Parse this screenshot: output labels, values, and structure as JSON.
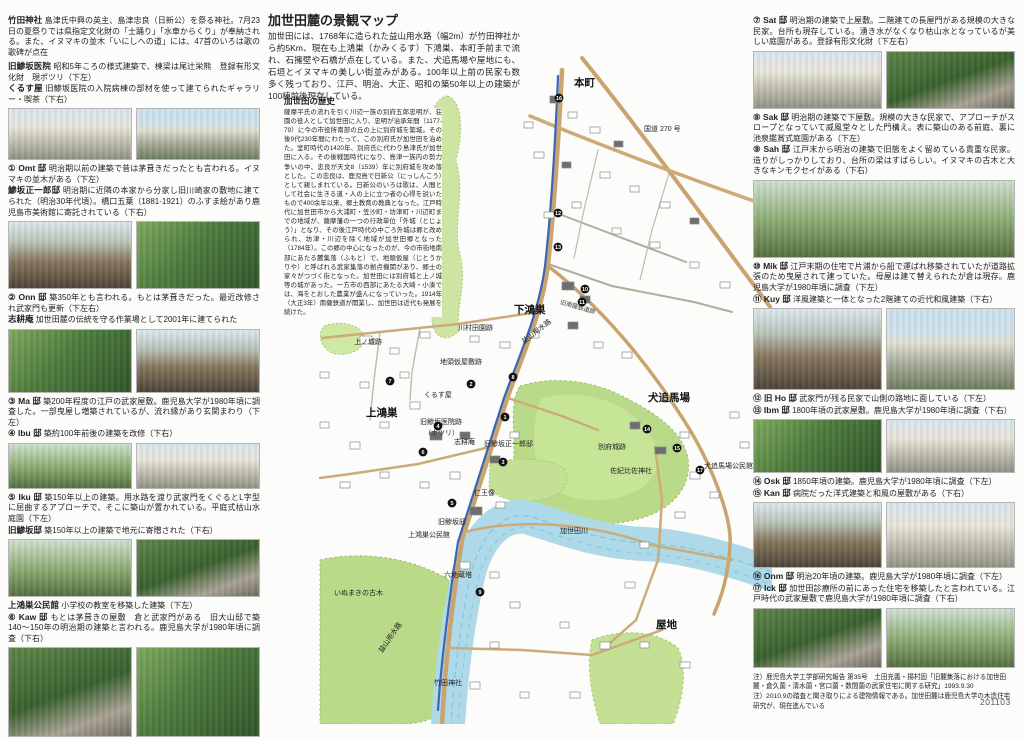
{
  "doc": {
    "number": "201103"
  },
  "center": {
    "title": "加世田麓の景観マップ",
    "intro": "加世田には、1768年に造られた益山用水路（幅2m）が竹田神社から約5Km、現在も上鴻巣（かみくるす）下鴻巣、本町手前まで流れ、石擁壁や石橋が点在している。また、犬追馬場や屋地にも、石垣とイヌマキの美しい街並みがある。100年以上前の民家も数多く残っており、江戸、明治、大正、昭和の築50年以上の建築が100棟前後現存している。",
    "history_title": "加世田の歴史",
    "history": "薩摩平氏の流れを引く川辺一族の別府五郎忠明が、荘園の役人として加世田に入り、忠明が治承年間（1177-79）に今の市役所南部の丘の上に別府城を築城。その後9代230年間にわたって、この別府氏が加世田を治めた。室町時代の1420年、別府氏に代わり島津氏が加世田に入る。その後戦国時代になり、島津一族内の勢力争いの中、忠良が天文8（1539）年に別府城を攻め落とした。この忠良は、鹿児島で日新公（にっしんこう）として親しまれている。日新公のいろは歌は、人間として社会に生きる道・人の上に立つ者の心得を説いたもので400余年以来、郷土教育の教典となった。江戸時代に加世田市から大浦町・笠沙町・坊津町・川辺町までの地域が、薩摩藩の一つの行政単位「外城（とじょう）」となり、その後江戸時代の中ごろ外城は郷と改められ、坊津・川辺を除く地域が加世田郷となった（1784年）。この郷の中心になったのが、今の市街地南部にあたる麓集落（ふもと）で、地頭仮屋（じとうかりや）と呼ばれる武家集落の拠点機関があり、郷士の家々がつづく街となった。加世田には別府城と上ノ城等の城があった。一方市の西部にあたる大崎・小湊では、海をとおした農業が盛んになっていった。1914年（大正3年）南薩鉄道が開業し、加世田は近代も発展を続けた。"
  },
  "left": {
    "intro": [
      {
        "label": "竹田神社",
        "body": "島津氏中興の英主、島津忠良（日新公）を祭る神社。7月23日の夏祭りでは県指定文化財の「士踊り」「水車からくり」が奉納される。また、イヌマキの並木「いにしへの道」には、47首のいろは歌の歌碑が点在"
      },
      {
        "label": "旧鯵坂医院",
        "body": "昭和5年ころの様式建築で、棟梁は尾辻栄熊　登録有形文化財　現ポツリ（下左）"
      },
      {
        "label": "くるす屋",
        "body": "旧鯵坂医院の入院病棟の部材を使って建てられたギャラリー・喫茶（下右）"
      }
    ],
    "entries": [
      {
        "num": "①",
        "label": "Omt 邸",
        "body": "明治期以前の建築で昔は茅葺きだったとも言われる。イヌマキの並木がある（下左）"
      },
      {
        "num": "",
        "label": "鯵坂正一郎邸",
        "body": "明治期に近隣の本家から分家し旧川崎家の敷地に建てられた（明治30年代頃）。橋口五葉（1881-1921）のふすま絵があり鹿児島市美術館に寄託されている（下右）"
      },
      {
        "num": "②",
        "label": "Onn 邸",
        "body": "築350年とも言われる。もとは茅葺きだった。最近改修され武家門も更新（下左右）"
      },
      {
        "num": "",
        "label": "志耕庵",
        "body": "加世田麓の伝統を守る作業場として2001年に建てられた"
      },
      {
        "num": "③",
        "label": "Ma 邸",
        "body": "築200年程度の江戸の武家屋敷。鹿児島大学が1980年頃に調査した。一部曳屋し増築されているが、流れ縁があり玄関まわり（下左）"
      },
      {
        "num": "④",
        "label": "Ibu 邸",
        "body": "築約100年前後の建築を改修（下右）"
      },
      {
        "num": "⑤",
        "label": "Iku 邸",
        "body": "築150年以上の建築。用水路を渡り武家門をくぐるとL字型に屈曲するアプローチで、そこに築山が置かれている。平庭式枯山水庭園（下左）"
      },
      {
        "num": "",
        "label": "旧鯵坂邸",
        "body": "築150年以上の建築で地元に寄贈された（下右）"
      },
      {
        "num": "",
        "label": "上鴻巣公民館",
        "body": "小学校の教室を移築した建築（下左）"
      },
      {
        "num": "⑥",
        "label": "Kaw 邸",
        "body": "もとは茅葺きの屋敷　倉と武家門がある　旧大山邸で築140〜150年の明治期の建築と言われる。鹿児島大学が1980年頃に調査（下右）"
      }
    ]
  },
  "right": {
    "entries": [
      {
        "num": "⑦",
        "label": "Sat 邸",
        "body": "明治期の建築で上屋敷。二階建ての長屋門がある規模の大きな民家。台所も現存している。湧き水がなくなり枯山水となっているが美しい庭園がある。登録有形文化財（下左右）"
      },
      {
        "num": "⑧",
        "label": "Sak 邸",
        "body": "明治期の建築で下屋敷。規模の大きな民家で、アプローチがスロープとなっていて威風堂々とした門構え。表に築山のある前庭、裏に池泉鑑賞式庭園がある（下左）"
      },
      {
        "num": "⑨",
        "label": "Sah 邸",
        "body": "江戸末から明治の建築で旧態をよく留めている貴重な民家。造りがしっかりしており、台所の梁はすばらしい。イヌマキの古木と大きなキンモクセイがある（下右）"
      },
      {
        "num": "⑩",
        "label": "Mik 邸",
        "body": "江戸末期の住宅で片浦から船で運ばれ移築されていたが道路拡張のため曳屋されて建っていた。母屋は建て替えられたが倉は現存。鹿児島大学が1980年頃に調査（下左）"
      },
      {
        "num": "⑪",
        "label": "Kuy 邸",
        "body": "洋風建築と一体となった2階建ての近代和風建築（下右）"
      },
      {
        "num": "⑫",
        "label": "旧 Ho 邸",
        "body": "武家門が残る民家で山側の路地に面している（下左）"
      },
      {
        "num": "⑬",
        "label": "Ibm 邸",
        "body": "1800年頃の武家屋敷。鹿児島大学が1980年頃に調査（下右）"
      },
      {
        "num": "⑭",
        "label": "Osk 邸",
        "body": "1850年頃の建築。鹿児島大学が1980年頃に調査（下左）"
      },
      {
        "num": "⑮",
        "label": "Kan 邸",
        "body": "病院だった洋式建築と和風の屋敷がある（下右）"
      },
      {
        "num": "⑯",
        "label": "Onm 邸",
        "body": "明治20年頃の建築。鹿児島大学が1980年頃に調査（下左）"
      },
      {
        "num": "⑰",
        "label": "Ick 邸",
        "body": "加世田診療所の前にあった住宅を移築したと言われている。江戸時代の武家屋敷で鹿児島大学が1980年頃に調査（下右）"
      }
    ],
    "notes": [
      "注）鹿児島大学工学部研究報告 第35号　土田充義・揚村固「旧麓集落における加世田麓・倉久薗・清水薗・宮口薗・数間薗の武家住宅に関する研究」1993.9.30",
      "注）2010.9の踏査と聞き取りによる建物情報である。加世田麓は鹿児島大学の木造住宅研究が、現在進んでいる"
    ]
  },
  "map": {
    "labels": [
      {
        "text": "本町",
        "x": 312,
        "y": 86,
        "cls": "lab-big"
      },
      {
        "text": "国道 270 号",
        "x": 382,
        "y": 131,
        "cls": "lab-sm"
      },
      {
        "text": "下鴻巣",
        "x": 252,
        "y": 313,
        "cls": "lab-big"
      },
      {
        "text": "川村田園跡",
        "x": 196,
        "y": 330,
        "cls": "lab-sm"
      },
      {
        "text": "益山用水路",
        "x": 262,
        "y": 344,
        "cls": "lab-sm",
        "rot": -38
      },
      {
        "text": "旧南薩鉄道跡",
        "x": 298,
        "y": 304,
        "cls": "lab-xs",
        "rot": 16
      },
      {
        "text": "上ノ城跡",
        "x": 92,
        "y": 344,
        "cls": "lab-sm"
      },
      {
        "text": "地頭仮屋敷跡",
        "x": 178,
        "y": 364,
        "cls": "lab-sm"
      },
      {
        "text": "上鴻巣",
        "x": 104,
        "y": 416,
        "cls": "lab-big"
      },
      {
        "text": "くるす屋",
        "x": 162,
        "y": 397,
        "cls": "lab-sm"
      },
      {
        "text": "旧鯵坂医院跡",
        "x": 158,
        "y": 424,
        "cls": "lab-sm"
      },
      {
        "text": "（ポツリ）",
        "x": 162,
        "y": 435,
        "cls": "lab-sm"
      },
      {
        "text": "志耕庵",
        "x": 192,
        "y": 444,
        "cls": "lab-sm"
      },
      {
        "text": "旧鯵坂正一郎邸",
        "x": 222,
        "y": 446,
        "cls": "lab-sm"
      },
      {
        "text": "別府城跡",
        "x": 336,
        "y": 449,
        "cls": "lab-sm"
      },
      {
        "text": "佐紀比佐神社",
        "x": 348,
        "y": 473,
        "cls": "lab-sm"
      },
      {
        "text": "犬追馬場",
        "x": 386,
        "y": 401,
        "cls": "lab-big"
      },
      {
        "text": "犬追馬場公民館",
        "x": 442,
        "y": 468,
        "cls": "lab-sm"
      },
      {
        "text": "仁王像",
        "x": 212,
        "y": 495,
        "cls": "lab-sm"
      },
      {
        "text": "旧鯵坂邸",
        "x": 176,
        "y": 524,
        "cls": "lab-sm"
      },
      {
        "text": "上鴻巣公民館",
        "x": 146,
        "y": 537,
        "cls": "lab-sm"
      },
      {
        "text": "六地蔵塔",
        "x": 182,
        "y": 577,
        "cls": "lab-sm"
      },
      {
        "text": "加世田川",
        "x": 298,
        "y": 533,
        "cls": "lab-sm"
      },
      {
        "text": "いぬまきの古木",
        "x": 72,
        "y": 595,
        "cls": "lab-sm"
      },
      {
        "text": "益山用水路",
        "x": 120,
        "y": 653,
        "cls": "lab-sm",
        "rot": -55
      },
      {
        "text": "竹田神社",
        "x": 172,
        "y": 685,
        "cls": "lab-sm"
      },
      {
        "text": "屋地",
        "x": 394,
        "y": 628,
        "cls": "lab-big"
      }
    ],
    "markers": [
      {
        "n": "1",
        "x": 243,
        "y": 417
      },
      {
        "n": "2",
        "x": 209,
        "y": 384
      },
      {
        "n": "3",
        "x": 241,
        "y": 462
      },
      {
        "n": "4",
        "x": 176,
        "y": 426
      },
      {
        "n": "5",
        "x": 190,
        "y": 503
      },
      {
        "n": "6",
        "x": 161,
        "y": 452
      },
      {
        "n": "7",
        "x": 128,
        "y": 381
      },
      {
        "n": "8",
        "x": 251,
        "y": 377
      },
      {
        "n": "9",
        "x": 218,
        "y": 592
      },
      {
        "n": "10",
        "x": 323,
        "y": 289
      },
      {
        "n": "11",
        "x": 320,
        "y": 302
      },
      {
        "n": "12",
        "x": 296,
        "y": 213
      },
      {
        "n": "13",
        "x": 296,
        "y": 247
      },
      {
        "n": "14",
        "x": 385,
        "y": 429
      },
      {
        "n": "15",
        "x": 415,
        "y": 448
      },
      {
        "n": "16",
        "x": 297,
        "y": 98
      },
      {
        "n": "17",
        "x": 438,
        "y": 470
      }
    ]
  }
}
